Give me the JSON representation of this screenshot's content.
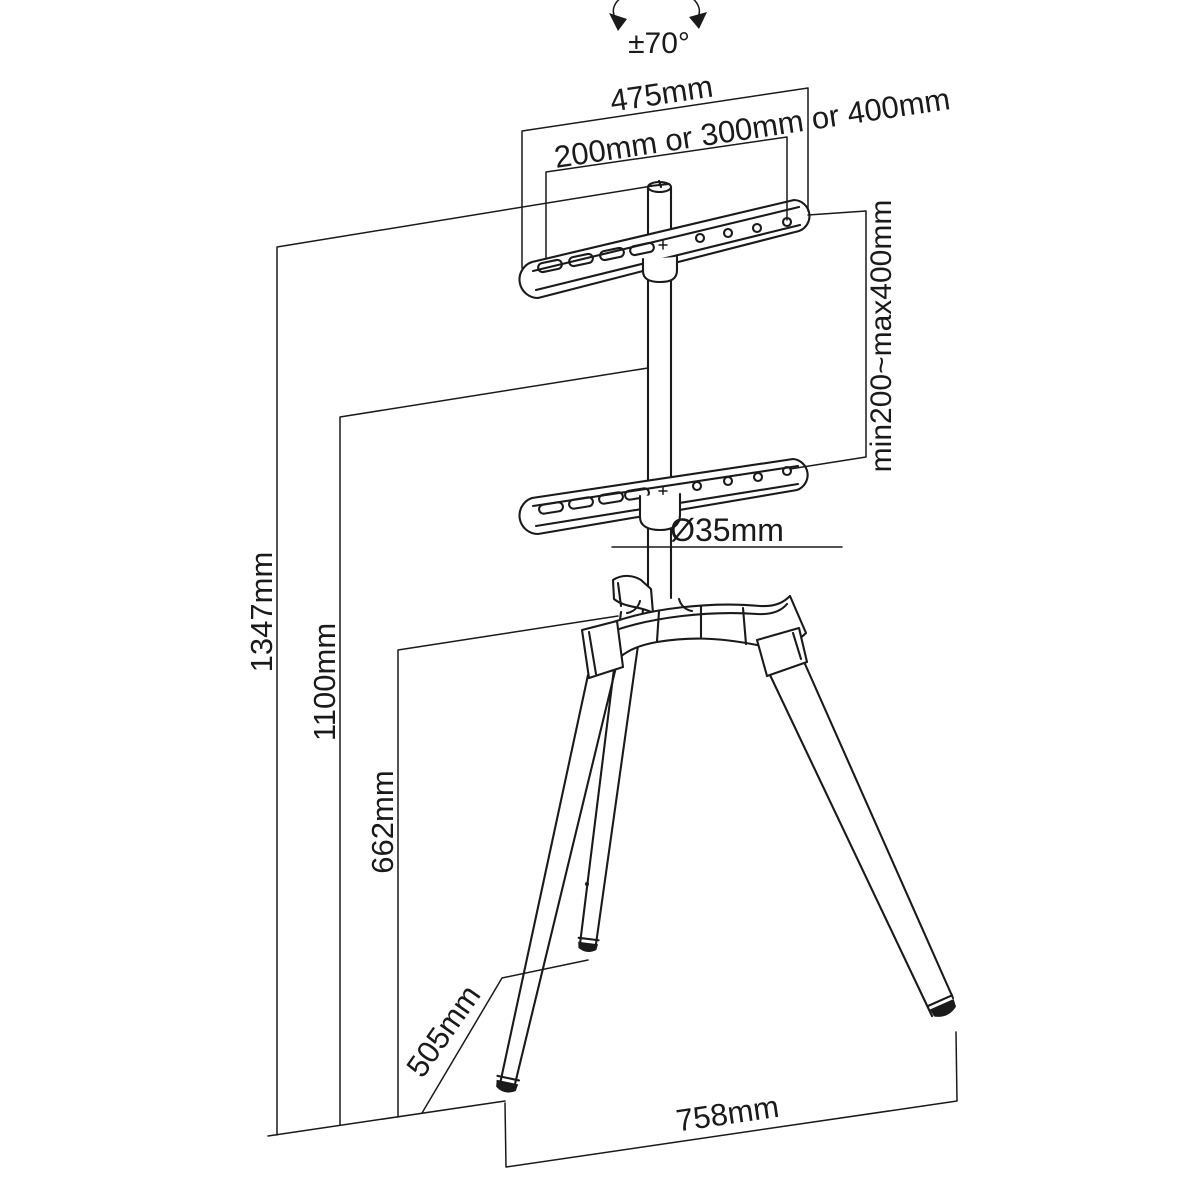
{
  "diagram": {
    "labels": {
      "tilt_angle": "±70°",
      "bracket_width": "475mm",
      "vesa_width": "200mm or 300mm or 400mm",
      "vesa_height_range": "min200~max400mm",
      "pole_diameter": "Ø35mm",
      "total_height": "1347mm",
      "column_height": "1100mm",
      "hub_height": "662mm",
      "base_depth": "505mm",
      "base_width": "758mm"
    },
    "colors": {
      "line": "#1a1a1a",
      "background": "#ffffff"
    }
  }
}
